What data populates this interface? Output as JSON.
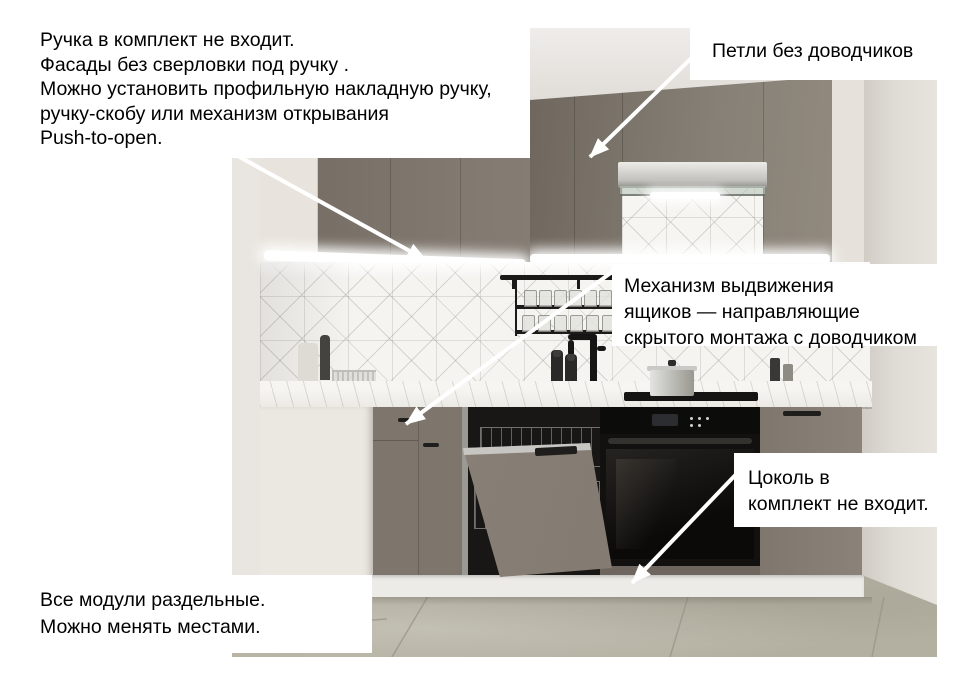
{
  "annotations": {
    "handle_note": {
      "lines": [
        "Ручка в комплект не входит.",
        "Фасады без сверловки под ручку .",
        "Можно установить профильную накладную ручку,",
        "ручку-скобу или механизм открывания",
        "Push-to-open."
      ]
    },
    "hinges_note": {
      "text": "Петли без доводчиков"
    },
    "drawer_note": {
      "lines": [
        "Механизм выдвижения",
        "ящиков — направляющие",
        "скрытого монтажа с доводчиком"
      ]
    },
    "plinth_note": {
      "lines": [
        "Цоколь в",
        "комплект не входит."
      ]
    },
    "modules_note": {
      "lines": [
        "Все модули раздельные.",
        "Можно менять местами."
      ]
    }
  },
  "colors": {
    "background": "#ffffff",
    "annotation_text": "#000000",
    "arrow": "#ffffff",
    "cabinet_taupe": "#867e74",
    "cabinet_cream": "#e8e3dc",
    "wall": "#dcd8d2",
    "floor": "#b3afa1",
    "countertop": "#f2f0ec",
    "appliance_black": "#141312"
  }
}
